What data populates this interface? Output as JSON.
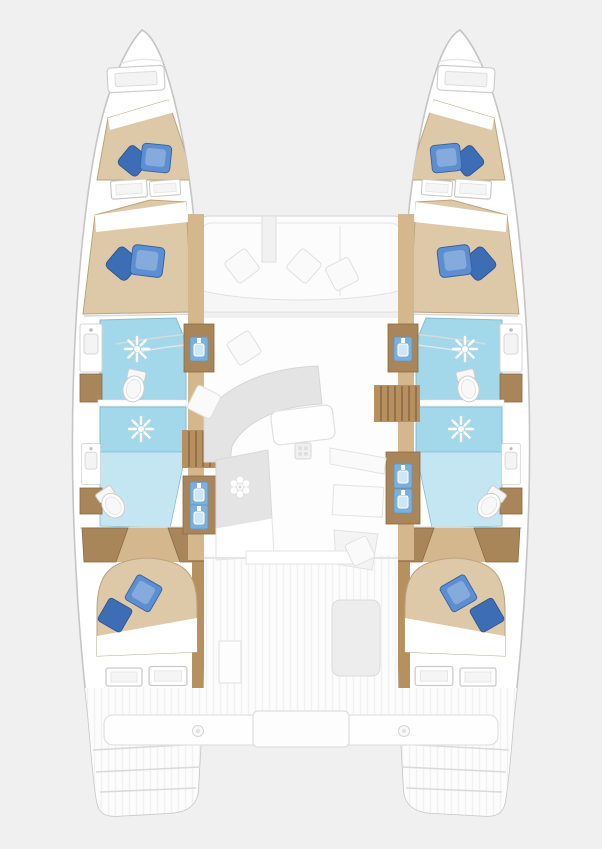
{
  "meta": {
    "description": "Top-down interior deck layout plan of a 4-cabin catamaran yacht",
    "view": "overhead floor plan",
    "visible_text": []
  },
  "colors": {
    "background": "#f0f0f0",
    "hull_fill": "#ffffff",
    "hull_stroke": "#c5c5c5",
    "wood_light": "#d5b78e",
    "wood_mid": "#b6905f",
    "wood_dark": "#a8865a",
    "wood_line": "#8a6a45",
    "bed_tan": "#ddc9a8",
    "bed_stroke": "#bba47b",
    "linen": "#ffffff",
    "pillow_blue": "#5d8ed1",
    "pillow_dark": "#3c6db5",
    "pillow_light": "#85abdd",
    "bath_blue": "#a3d8ea",
    "bath_blue_light": "#c4e6f2",
    "bath_stroke": "#85bdd2",
    "sink_blue": "#79b1dc",
    "furniture_gray": "#e4e4e4",
    "line_gray": "#d9d9d9",
    "deck_white": "#fcfcfc"
  },
  "structure": {
    "hulls": [
      {
        "side": "port-left",
        "rooms": [
          "bow locker with hatch",
          "forward double berth",
          "mid double berth",
          "forward bathroom with shower and toilet",
          "aft bathroom with shower and toilet",
          "aft double cabin",
          "stern steps"
        ]
      },
      {
        "side": "starboard-right",
        "rooms": [
          "bow locker with hatch",
          "forward double berth",
          "mid double berth",
          "forward bathroom with shower and toilet",
          "aft bathroom with shower and toilet",
          "aft double cabin",
          "stern steps"
        ]
      }
    ],
    "bridge_deck": [
      "forward cockpit seating with three cushions",
      "salon with curved sofa and coffee table",
      "galley counter with stove",
      "chart table and nav seat",
      "aft cockpit with table",
      "aft crossbeam bench with center step"
    ]
  },
  "fixtures": [
    {
      "name": "bow-hatch-left",
      "type": "hatch",
      "x": 136,
      "y": 79,
      "rot": -3,
      "scale": 0.95
    },
    {
      "name": "bow-hatch-right",
      "type": "hatch",
      "x": 466,
      "y": 79,
      "rot": 3,
      "scale": 0.95
    },
    {
      "name": "pillows-fwd-berth-left",
      "type": "pillow-pair",
      "x": 151,
      "y": 159,
      "rot": -6,
      "scale": 1.1
    },
    {
      "name": "window-fwd-cabin-left-1",
      "type": "window",
      "x": 129,
      "y": 189,
      "rot": -4
    },
    {
      "name": "window-fwd-cabin-left-2",
      "type": "window",
      "x": 165,
      "y": 188,
      "rot": -4,
      "scale": 0.85
    },
    {
      "name": "pillows-mid-berth-left",
      "type": "pillow-pair",
      "x": 142,
      "y": 262,
      "rot": -5,
      "scale": 1.2
    },
    {
      "name": "shower-fwd-left",
      "type": "shower",
      "x": 137,
      "y": 349
    },
    {
      "name": "toilet-fwd-left",
      "type": "toilet",
      "x": 134,
      "y": 387,
      "rot": 12
    },
    {
      "name": "vanity-fwd-left",
      "type": "vanity",
      "x": 91,
      "y": 348
    },
    {
      "name": "shower-aft-left",
      "type": "shower",
      "x": 141,
      "y": 429
    },
    {
      "name": "toilet-aft-left",
      "type": "toilet",
      "x": 112,
      "y": 504,
      "rot": -35
    },
    {
      "name": "vanity-aft-left",
      "type": "vanity",
      "x": 91,
      "y": 464,
      "scale": 0.85
    },
    {
      "name": "pillows-aft-cabin-left",
      "type": "pillow-aft",
      "x": 133,
      "y": 603,
      "rot": -10,
      "scale": 1.1
    },
    {
      "name": "window-aft-cabin-left-1",
      "type": "window",
      "x": 124,
      "y": 677
    },
    {
      "name": "window-aft-cabin-left-2",
      "type": "window",
      "x": 168,
      "y": 676,
      "scale": 1.05
    },
    {
      "name": "basin-fwd-walkway-left",
      "type": "blue-sink",
      "x": 199,
      "y": 349
    },
    {
      "name": "basin-aft-walkway-left-1",
      "type": "blue-sink",
      "x": 199,
      "y": 494
    },
    {
      "name": "basin-aft-walkway-left-2",
      "type": "blue-sink",
      "x": 199,
      "y": 517
    },
    {
      "name": "pillows-fwd-berth-right",
      "type": "pillow-pair",
      "x": 451,
      "y": 159,
      "rot": 6,
      "flip": true,
      "scale": 1.1
    },
    {
      "name": "window-fwd-cabin-right-1",
      "type": "window",
      "x": 473,
      "y": 189,
      "rot": 4
    },
    {
      "name": "window-fwd-cabin-right-2",
      "type": "window",
      "x": 437,
      "y": 188,
      "rot": 4,
      "scale": 0.85
    },
    {
      "name": "pillows-mid-berth-right",
      "type": "pillow-pair",
      "x": 460,
      "y": 262,
      "rot": 5,
      "flip": true,
      "scale": 1.2
    },
    {
      "name": "shower-fwd-right",
      "type": "shower",
      "x": 465,
      "y": 349
    },
    {
      "name": "toilet-fwd-right",
      "type": "toilet",
      "x": 468,
      "y": 387,
      "rot": -12
    },
    {
      "name": "vanity-fwd-right",
      "type": "vanity",
      "x": 511,
      "y": 348
    },
    {
      "name": "shower-aft-right",
      "type": "shower",
      "x": 461,
      "y": 429
    },
    {
      "name": "toilet-aft-right",
      "type": "toilet",
      "x": 490,
      "y": 504,
      "rot": 35
    },
    {
      "name": "vanity-aft-right",
      "type": "vanity",
      "x": 511,
      "y": 464,
      "scale": 0.85
    },
    {
      "name": "pillows-aft-cabin-right",
      "type": "pillow-aft",
      "x": 469,
      "y": 603,
      "rot": 10,
      "flip": true,
      "scale": 1.1
    },
    {
      "name": "window-aft-cabin-right-1",
      "type": "window",
      "x": 478,
      "y": 677
    },
    {
      "name": "window-aft-cabin-right-2",
      "type": "window",
      "x": 434,
      "y": 676,
      "scale": 1.05
    },
    {
      "name": "basin-fwd-walkway-right",
      "type": "blue-sink",
      "x": 403,
      "y": 349
    },
    {
      "name": "basin-aft-walkway-right-1",
      "type": "blue-sink",
      "x": 403,
      "y": 476
    },
    {
      "name": "basin-aft-walkway-right-2",
      "type": "blue-sink",
      "x": 403,
      "y": 501
    },
    {
      "name": "cushion-fwd-cockpit-1",
      "type": "cushion",
      "x": 242,
      "y": 266,
      "rot": 8
    },
    {
      "name": "cushion-fwd-cockpit-2",
      "type": "cushion",
      "x": 304,
      "y": 266,
      "rot": -4
    },
    {
      "name": "cushion-fwd-cockpit-3",
      "type": "cushion",
      "x": 342,
      "y": 274,
      "rot": 18
    },
    {
      "name": "cushion-salon-1",
      "type": "cushion",
      "x": 244,
      "y": 348,
      "rot": 12
    },
    {
      "name": "cushion-salon-2",
      "type": "cushion",
      "x": 204,
      "y": 402,
      "rot": -18
    },
    {
      "name": "stove-galley",
      "type": "stove",
      "x": 240,
      "y": 487
    },
    {
      "name": "sink-grate-galley",
      "type": "grate",
      "x": 303,
      "y": 451
    },
    {
      "name": "cushion-nav-seat",
      "type": "cushion",
      "x": 360,
      "y": 551,
      "rot": 20,
      "scale": 0.9
    },
    {
      "name": "bolt-aft-beam-left",
      "type": "bolt",
      "x": 198,
      "y": 731
    },
    {
      "name": "bolt-aft-beam-right",
      "type": "bolt",
      "x": 404,
      "y": 731
    }
  ]
}
